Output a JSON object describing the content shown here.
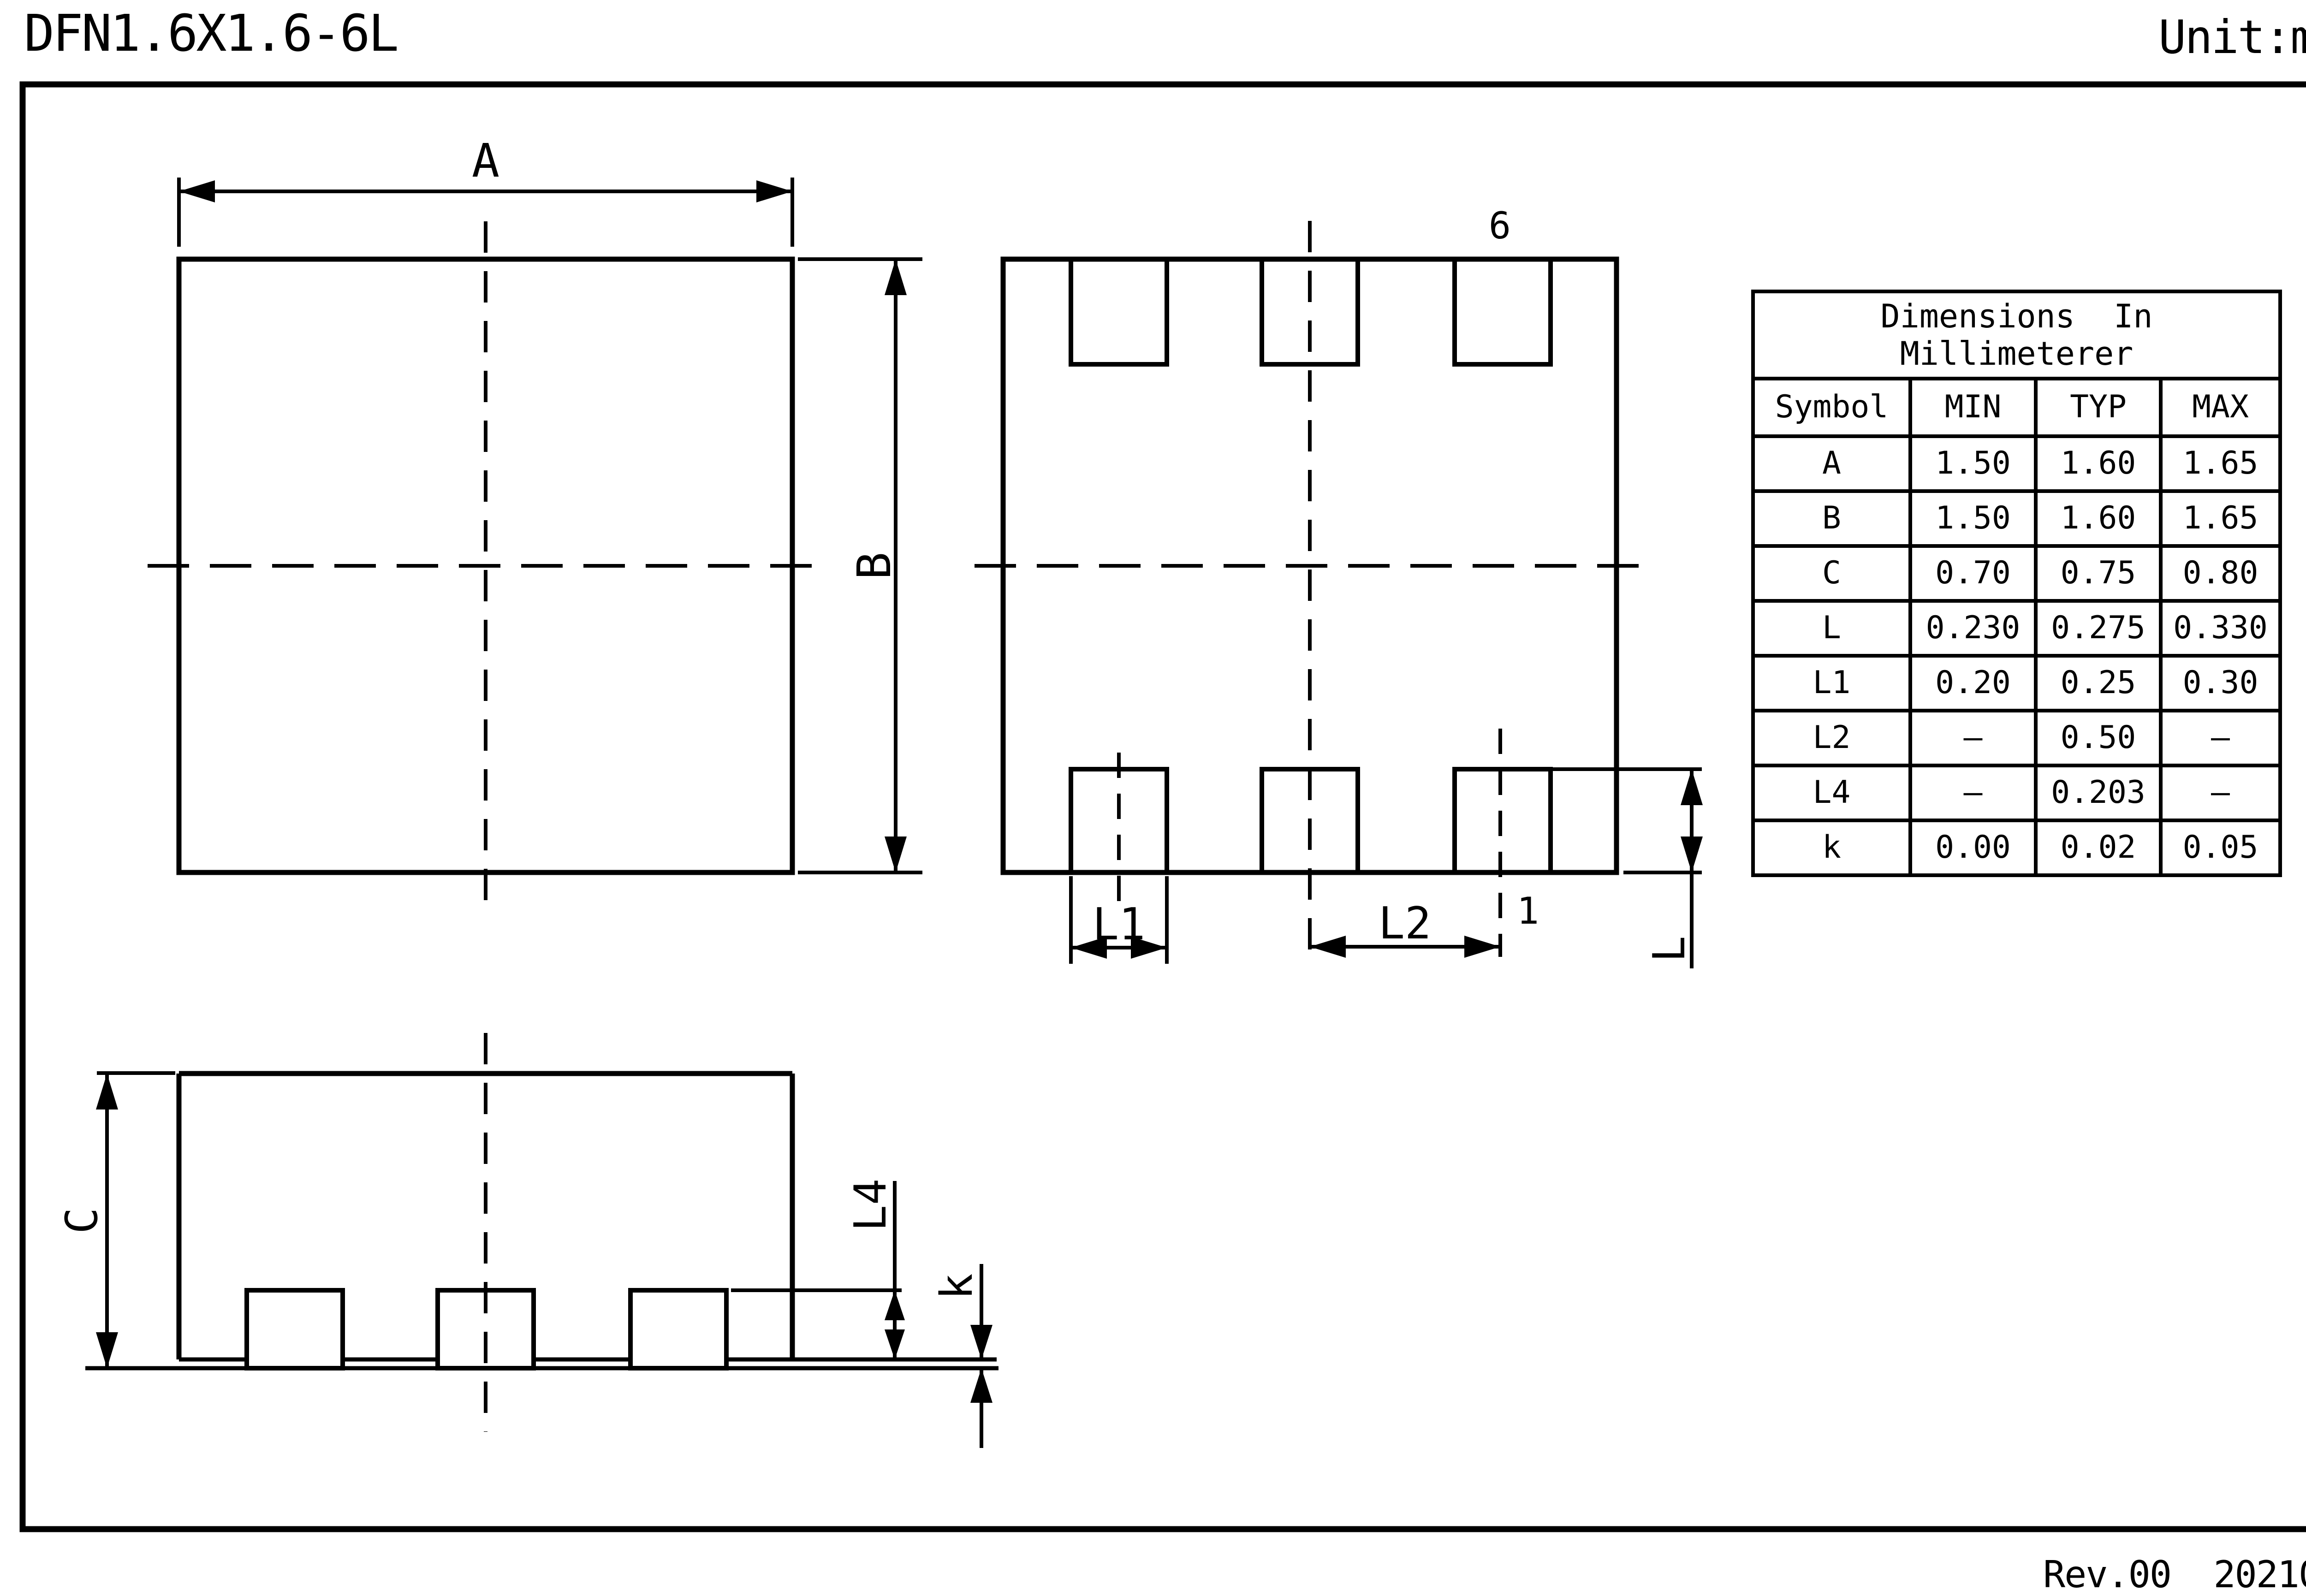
{
  "page": {
    "title": "DFN1.6X1.6-6L",
    "unit": "Unit:mm",
    "revision": "Rev.00  202107"
  },
  "drawing": {
    "background": "#ffffff",
    "line_color": "#000000",
    "views": {
      "top": {
        "dim_width": "A",
        "dim_height": "B"
      },
      "bottom": {
        "dim_pad_width": "L1",
        "dim_pad_pitch": "L2",
        "dim_pad_length": "L",
        "pin_last": "6",
        "pin_first": "1"
      },
      "side": {
        "dim_height": "C",
        "dim_lead": "L4",
        "dim_standoff": "k"
      }
    }
  },
  "table": {
    "title_line1": "Dimensions  In",
    "title_line2": "Millimeterer",
    "headers": [
      "Symbol",
      "MIN",
      "TYP",
      "MAX"
    ],
    "rows": [
      {
        "symbol": "A",
        "min": "1.50",
        "typ": "1.60",
        "max": "1.65"
      },
      {
        "symbol": "B",
        "min": "1.50",
        "typ": "1.60",
        "max": "1.65"
      },
      {
        "symbol": "C",
        "min": "0.70",
        "typ": "0.75",
        "max": "0.80"
      },
      {
        "symbol": "L",
        "min": "0.230",
        "typ": "0.275",
        "max": "0.330"
      },
      {
        "symbol": "L1",
        "min": "0.20",
        "typ": "0.25",
        "max": "0.30"
      },
      {
        "symbol": "L2",
        "min": "–",
        "typ": "0.50",
        "max": "–"
      },
      {
        "symbol": "L4",
        "min": "–",
        "typ": "0.203",
        "max": "–"
      },
      {
        "symbol": "k",
        "min": "0.00",
        "typ": "0.02",
        "max": "0.05"
      }
    ]
  }
}
